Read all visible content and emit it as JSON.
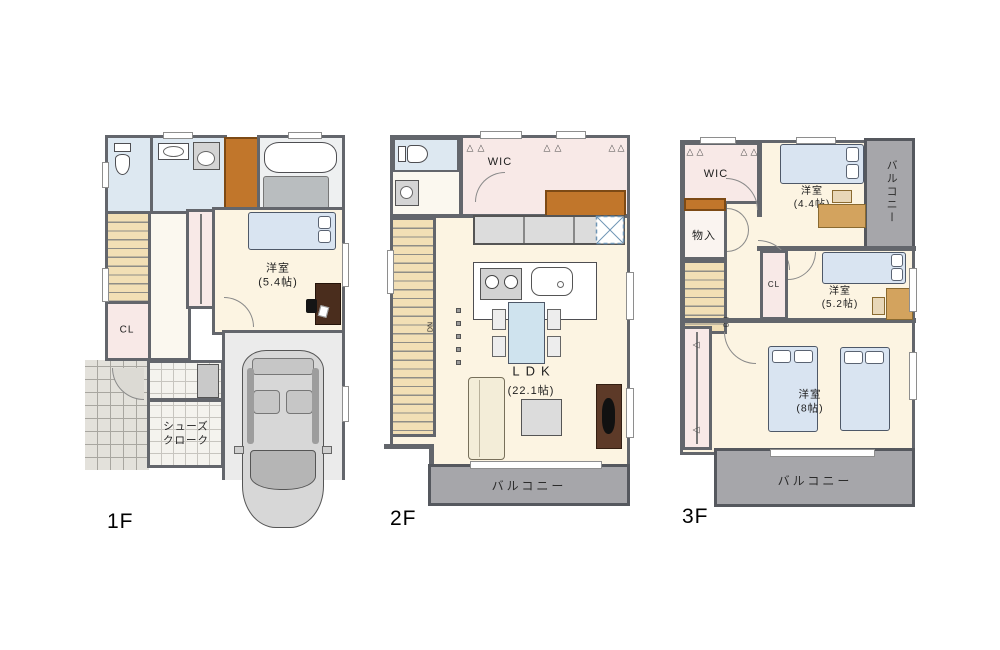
{
  "floors": {
    "f1": {
      "label": "1F",
      "bedroom_label": "洋室\n(5.4帖)",
      "closet_label": "CL",
      "shoes_closet_label": "シューズ\nクローク"
    },
    "f2": {
      "label": "2F",
      "wic_label": "WIC",
      "ldk_label": "LDK",
      "ldk_size": "(22.1帖)",
      "balcony_label": "バルコニー",
      "down_label": "DN"
    },
    "f3": {
      "label": "3F",
      "wic_label": "WIC",
      "storage_label": "物入",
      "bedroom44_label": "洋室\n(4.4帖)",
      "bedroom52_label": "洋室\n(5.2帖)",
      "bedroom8_label": "洋室\n(8帖)",
      "closet_mid_label": "CL",
      "balcony_side_label": "バルコニー",
      "balcony_bottom_label": "バルコニー",
      "down_label": "DN"
    }
  },
  "icons": {
    "hanger": "△"
  },
  "colors": {
    "wall": "#63666c",
    "cream": "#fcf4e2",
    "wet": "#dde8f1",
    "pink": "#f8e9e7",
    "stairs": "#f2dfb5",
    "cabinet": "#c1762b",
    "balcony": "#a6a6aa",
    "bed": "#d9e4f1",
    "garage": "#ebebeb",
    "wood": "#4a2d1d"
  }
}
